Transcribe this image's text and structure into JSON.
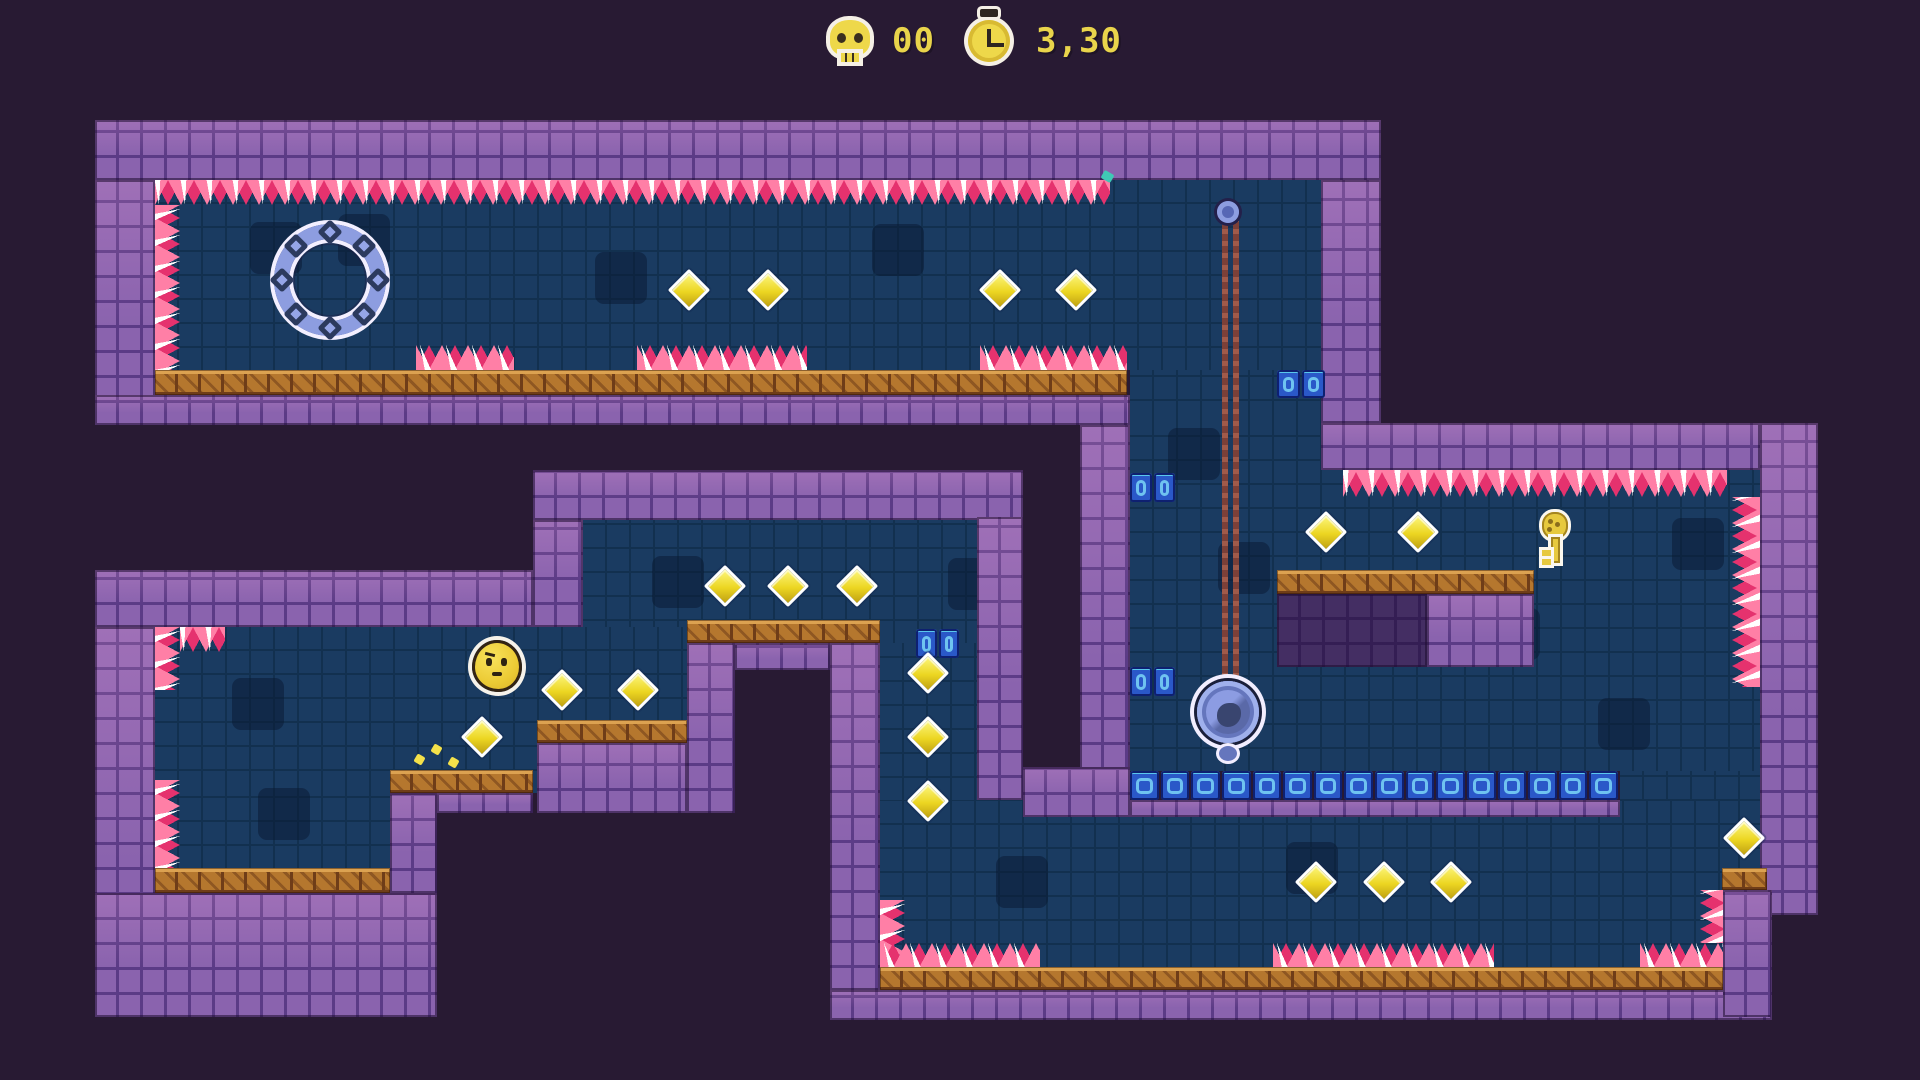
{
  "meta": {
    "width": 1920,
    "height": 1080,
    "background": "#281a33"
  },
  "hud": {
    "skull_icon": "skull-icon",
    "deaths": "00",
    "stopwatch_icon": "stopwatch-icon",
    "time": "3,30",
    "text_color": "#e9d44b"
  },
  "palette": {
    "background": "#281a33",
    "wall_brick": "#8a63ae",
    "wall_mortar": "#5b3b86",
    "interior": "#1a3b61",
    "platform_wood": "#b5772e",
    "spike_pink": "#e5326e",
    "spike_light": "#ff7fa6",
    "blue_block": "#2a58c8",
    "blue_block_inner": "#6fc3f0",
    "gem_yellow": "#ecd622",
    "object_periwinkle": "#8d9de0",
    "chain_brown": "#7c4038",
    "player_yellow": "#eccb35",
    "leaf_teal": "#2ec3ac",
    "hud_yellow": "#e9d44b"
  },
  "level": {
    "interiors": [
      [
        155,
        180,
        1166,
        190
      ],
      [
        1130,
        370,
        191,
        53
      ],
      [
        1130,
        423,
        630,
        348
      ],
      [
        1620,
        771,
        140,
        196
      ],
      [
        880,
        800,
        843,
        167
      ],
      [
        880,
        627,
        143,
        173
      ],
      [
        583,
        520,
        440,
        123
      ],
      [
        155,
        627,
        532,
        166
      ],
      [
        155,
        793,
        235,
        75
      ]
    ],
    "decor": [
      [
        250,
        222
      ],
      [
        595,
        252
      ],
      [
        872,
        224
      ],
      [
        1168,
        428
      ],
      [
        1218,
        542
      ],
      [
        948,
        558
      ],
      [
        652,
        556
      ],
      [
        1488,
        608
      ],
      [
        1598,
        698
      ],
      [
        996,
        856
      ],
      [
        1286,
        842
      ],
      [
        232,
        678
      ],
      [
        258,
        788
      ],
      [
        1672,
        518
      ],
      [
        338,
        214
      ]
    ],
    "walls": [
      [
        95,
        120,
        1286,
        60
      ],
      [
        95,
        180,
        60,
        245
      ],
      [
        95,
        395,
        1035,
        30
      ],
      [
        1321,
        180,
        60,
        243
      ],
      [
        1321,
        423,
        439,
        47
      ],
      [
        1760,
        423,
        58,
        492
      ],
      [
        1080,
        425,
        50,
        392
      ],
      [
        1023,
        767,
        107,
        50
      ],
      [
        1130,
        800,
        490,
        17
      ],
      [
        533,
        470,
        490,
        50
      ],
      [
        533,
        520,
        50,
        107
      ],
      [
        95,
        570,
        438,
        57
      ],
      [
        95,
        627,
        60,
        390
      ],
      [
        95,
        893,
        342,
        124
      ],
      [
        390,
        793,
        47,
        100
      ],
      [
        437,
        793,
        96,
        20
      ],
      [
        537,
        743,
        150,
        70
      ],
      [
        687,
        643,
        48,
        170
      ],
      [
        735,
        643,
        95,
        27
      ],
      [
        830,
        643,
        50,
        347
      ],
      [
        977,
        517,
        46,
        283
      ],
      [
        1427,
        594,
        107,
        73
      ],
      [
        830,
        990,
        942,
        30
      ],
      [
        1723,
        890,
        49,
        127
      ]
    ],
    "walls_dark": [
      [
        1277,
        594,
        150,
        73
      ]
    ],
    "platforms": [
      [
        155,
        370,
        972,
        25
      ],
      [
        1277,
        570,
        257,
        24
      ],
      [
        687,
        620,
        193,
        23
      ],
      [
        537,
        720,
        150,
        23
      ],
      [
        390,
        770,
        143,
        23
      ],
      [
        155,
        868,
        235,
        25
      ],
      [
        880,
        967,
        843,
        23
      ],
      [
        1722,
        868,
        45,
        22
      ]
    ],
    "blue_strips": [
      [
        1130,
        771,
        490,
        29
      ],
      [
        1277,
        370,
        50,
        28
      ],
      [
        1130,
        473,
        47,
        29
      ],
      [
        1130,
        667,
        47,
        29
      ],
      [
        916,
        629,
        45,
        29
      ]
    ],
    "spikes": [
      {
        "x": 155,
        "y": 180,
        "w": 955,
        "h": 25,
        "dir": "down"
      },
      {
        "x": 155,
        "y": 205,
        "w": 25,
        "h": 165,
        "dir": "right"
      },
      {
        "x": 416,
        "y": 345,
        "w": 98,
        "h": 25,
        "dir": "up"
      },
      {
        "x": 637,
        "y": 345,
        "w": 170,
        "h": 25,
        "dir": "up"
      },
      {
        "x": 980,
        "y": 345,
        "w": 147,
        "h": 25,
        "dir": "up"
      },
      {
        "x": 1343,
        "y": 470,
        "w": 384,
        "h": 27,
        "dir": "down"
      },
      {
        "x": 1732,
        "y": 497,
        "w": 28,
        "h": 190,
        "dir": "left"
      },
      {
        "x": 180,
        "y": 627,
        "w": 45,
        "h": 25,
        "dir": "down"
      },
      {
        "x": 155,
        "y": 627,
        "w": 25,
        "h": 63,
        "dir": "right"
      },
      {
        "x": 155,
        "y": 780,
        "w": 25,
        "h": 88,
        "dir": "right"
      },
      {
        "x": 880,
        "y": 900,
        "w": 25,
        "h": 67,
        "dir": "right"
      },
      {
        "x": 880,
        "y": 943,
        "w": 160,
        "h": 24,
        "dir": "up"
      },
      {
        "x": 1273,
        "y": 943,
        "w": 221,
        "h": 24,
        "dir": "up"
      },
      {
        "x": 1640,
        "y": 943,
        "w": 83,
        "h": 24,
        "dir": "up"
      },
      {
        "x": 1700,
        "y": 890,
        "w": 23,
        "h": 53,
        "dir": "left"
      }
    ],
    "diamonds": [
      [
        689,
        290
      ],
      [
        768,
        290
      ],
      [
        1000,
        290
      ],
      [
        1076,
        290
      ],
      [
        1326,
        532
      ],
      [
        1418,
        532
      ],
      [
        725,
        586
      ],
      [
        788,
        586
      ],
      [
        857,
        586
      ],
      [
        562,
        690
      ],
      [
        638,
        690
      ],
      [
        482,
        737
      ],
      [
        928,
        673
      ],
      [
        928,
        737
      ],
      [
        928,
        801
      ],
      [
        1316,
        882
      ],
      [
        1384,
        882
      ],
      [
        1451,
        882
      ],
      [
        1744,
        838
      ]
    ],
    "objects": {
      "ring": {
        "cx": 330,
        "cy": 280,
        "d": 112,
        "bolts": 8
      },
      "chain": {
        "x1": 1222,
        "x2": 1233,
        "top": 212,
        "bottom": 678,
        "pivot_cx": 1228,
        "pivot_cy": 212
      },
      "ball": {
        "cx": 1228,
        "cy": 712,
        "d": 62
      },
      "key": {
        "cx": 1555,
        "cy": 540
      },
      "player": {
        "cx": 497,
        "cy": 662
      },
      "particles_yellow": [
        [
          432,
          745
        ],
        [
          415,
          755
        ],
        [
          449,
          758
        ]
      ],
      "particles_teal": [
        [
          1102,
          172
        ]
      ]
    }
  }
}
